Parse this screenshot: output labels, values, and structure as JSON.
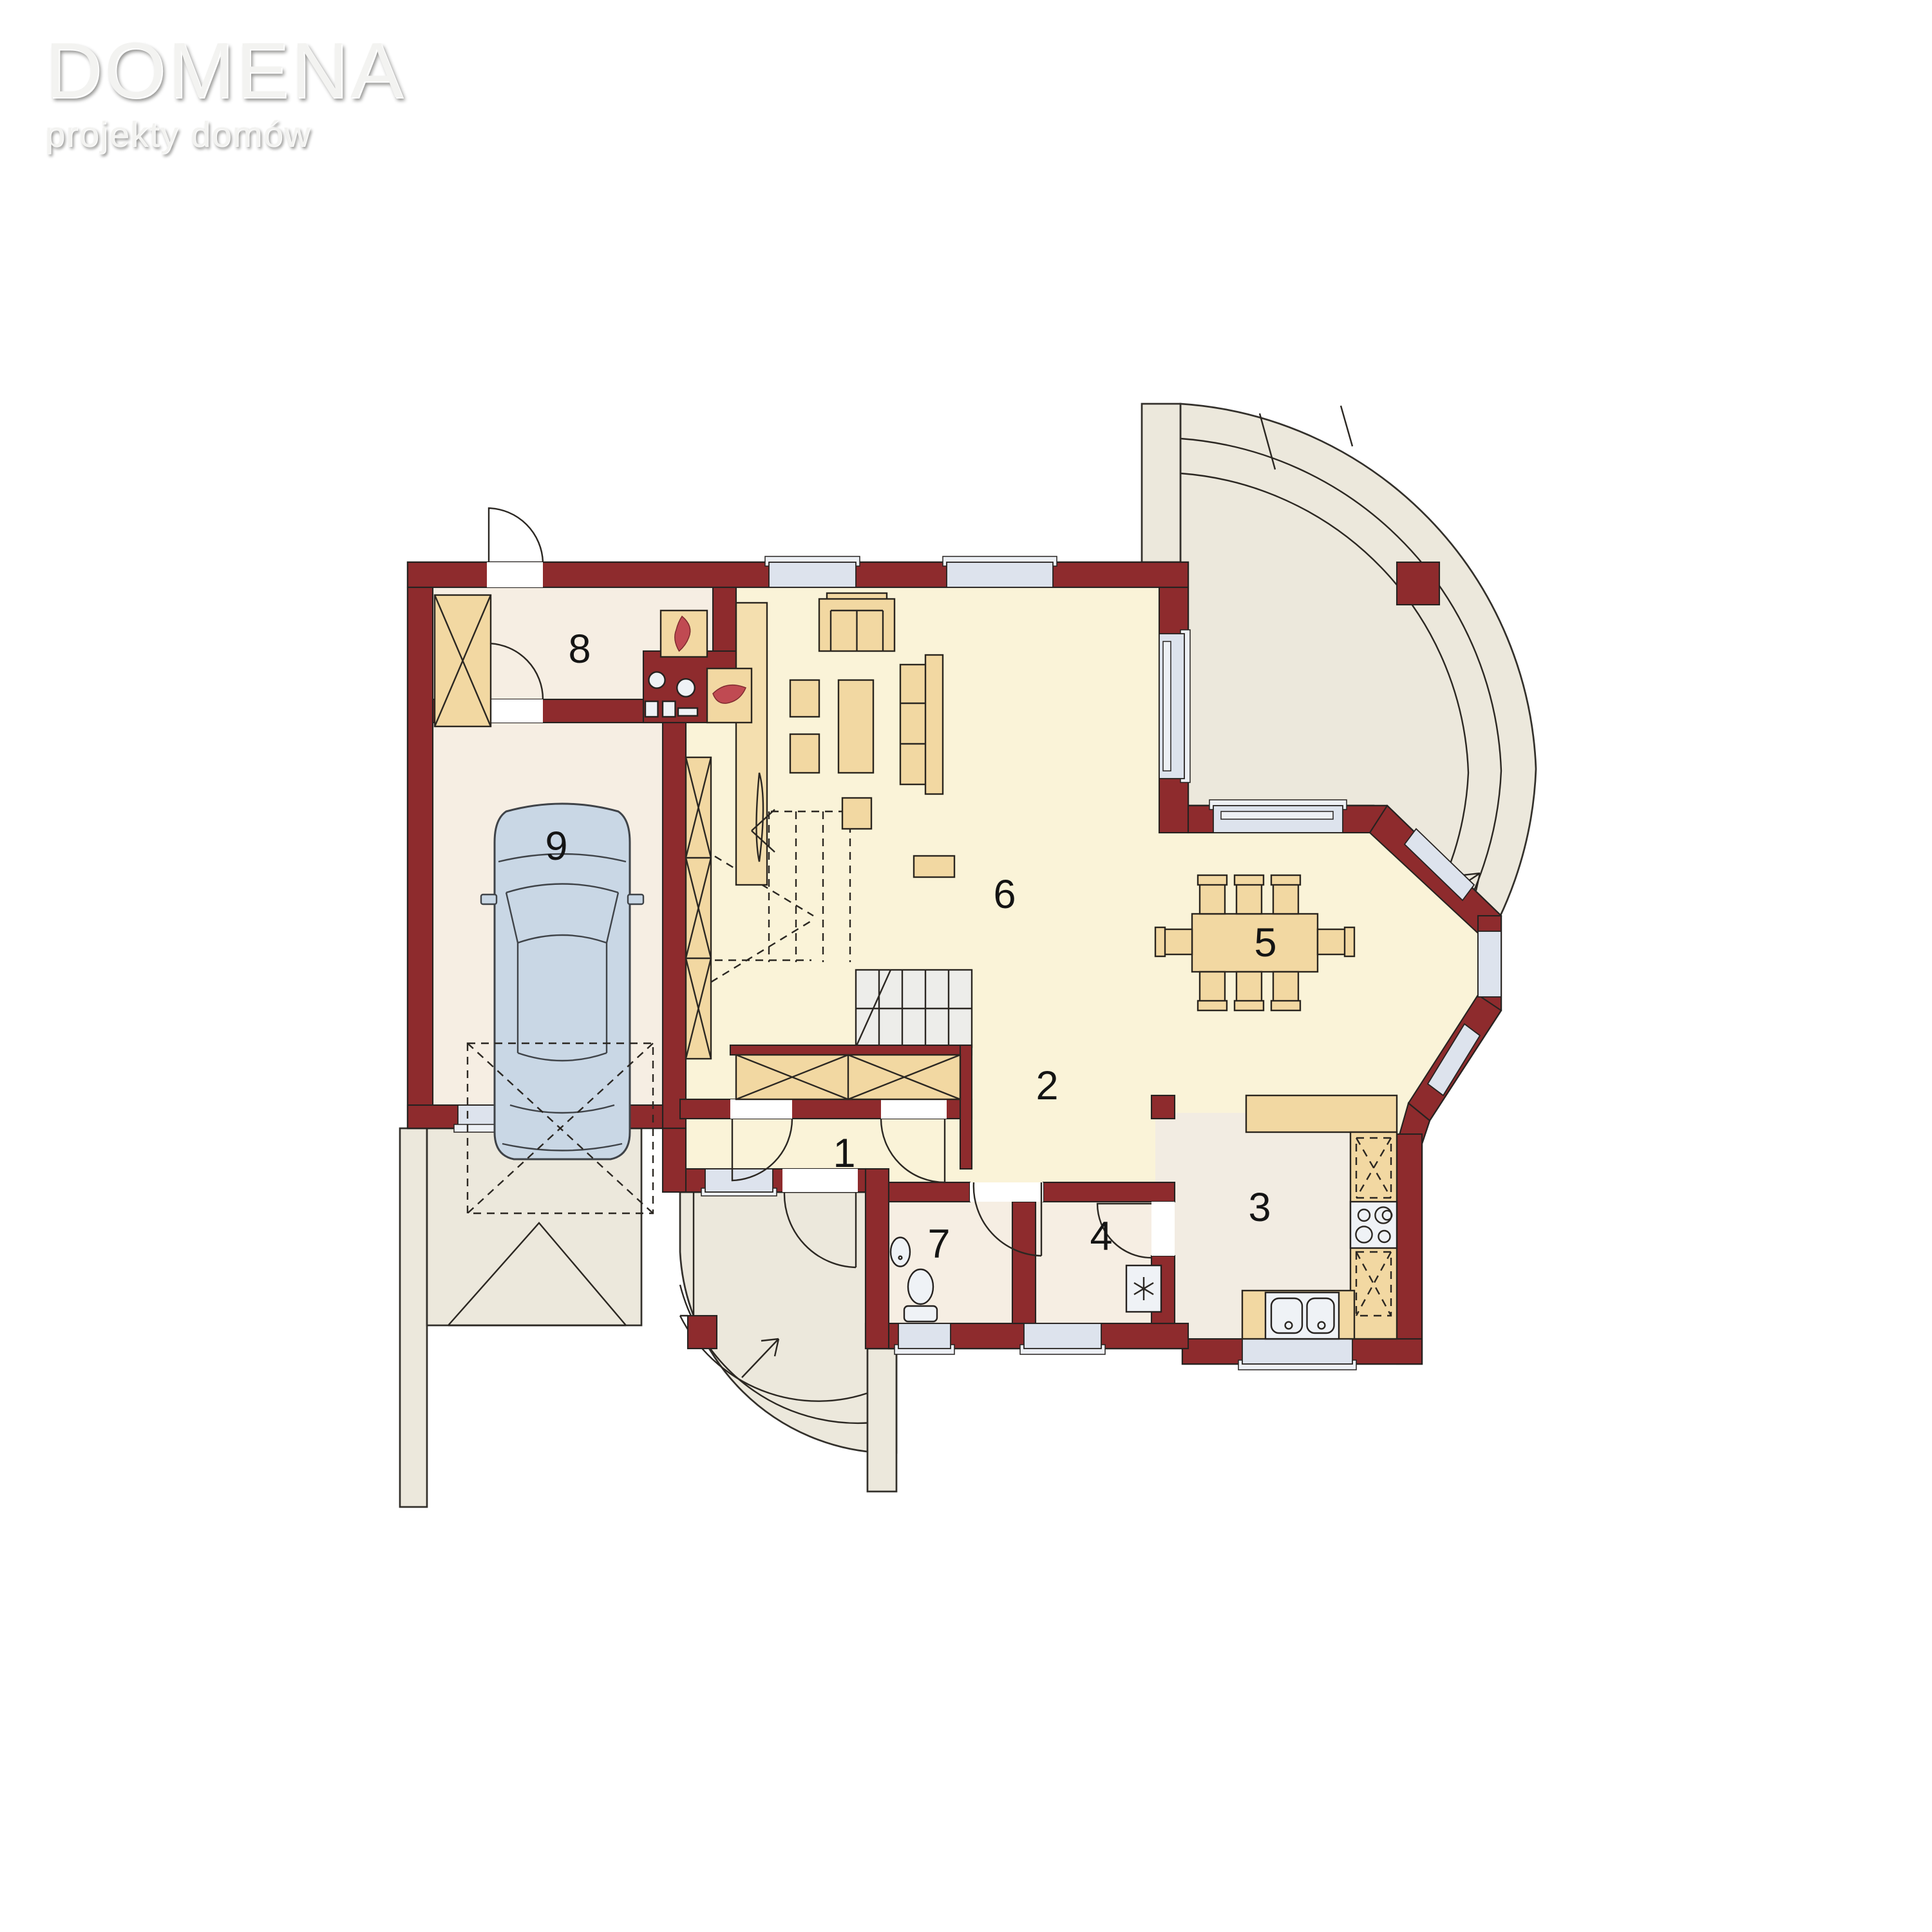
{
  "logo": {
    "title": "DOMENA",
    "subtitle": "projekty domów"
  },
  "rooms": [
    {
      "number": "1"
    },
    {
      "number": "2"
    },
    {
      "number": "3"
    },
    {
      "number": "4"
    },
    {
      "number": "5"
    },
    {
      "number": "6"
    },
    {
      "number": "7"
    },
    {
      "number": "8"
    },
    {
      "number": "9"
    }
  ],
  "colors": {
    "wall": "#8E2B2D",
    "floor_living": "#FAF3D8",
    "floor_service": "#F6EEE3",
    "floor_kitchen": "#F2ECE2",
    "outdoor": "#ECE8DC",
    "furniture": "#F2D8A2",
    "window": "#DDE3ED",
    "car": "#C9D7E5",
    "flame": "#C04A52",
    "steps": "#EDEDEA"
  }
}
